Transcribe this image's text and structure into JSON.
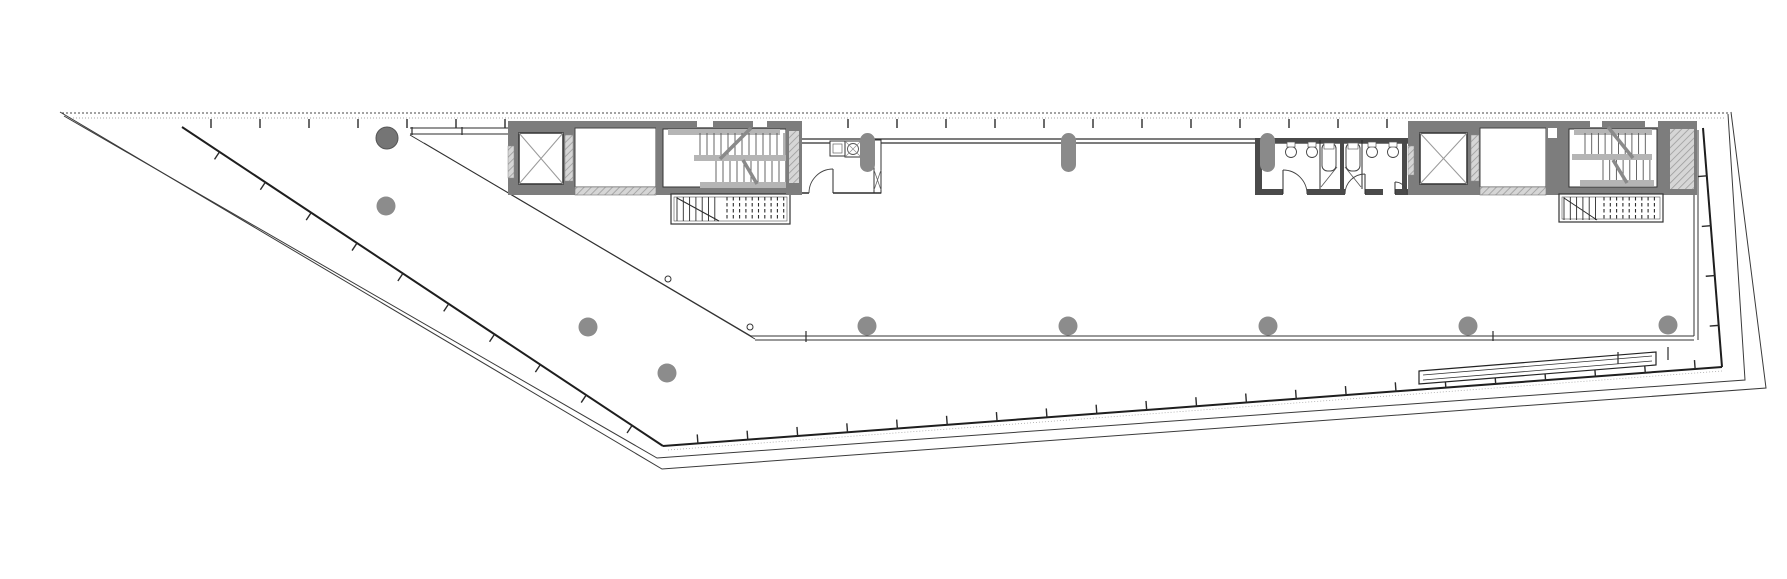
{
  "document": {
    "type": "architectural-floor-plan",
    "description": "Wedge-shaped office floor plate with two cores, drawn as black line work on white"
  },
  "canvas": {
    "width": 1787,
    "height": 579,
    "background": "#ffffff"
  },
  "colors": {
    "ink": "#2b2b2b",
    "thin": "#3a3a3a",
    "wall_gray": "#7d7d7d",
    "dark_wall": "#4a4a4a",
    "hatch_gray": "#c9c9c9",
    "landing_gray": "#b5b5b5",
    "tread": "#555555",
    "light_gray": "#9a9a9a",
    "column_gray": "#8c8c8c",
    "column_dark": "#757575",
    "dotted_gray": "#aaaaaa"
  },
  "top_edge": {
    "dashed_lines": [
      {
        "x1": 62,
        "y1": 113,
        "x2": 1729,
        "y2": 113,
        "color": "#444444",
        "dash": "2 2",
        "w": 1
      },
      {
        "x1": 70,
        "y1": 118,
        "x2": 1725,
        "y2": 118,
        "color": "#aaaaaa",
        "dash": "1 2",
        "w": 1
      }
    ],
    "ticks": {
      "y1": 119,
      "y2": 128,
      "x_start": 211,
      "x_end": 1690,
      "step": 49,
      "skip": [
        [
          506,
          800
        ],
        [
          1408,
          1700
        ]
      ]
    }
  },
  "outer_outline": {
    "a": [
      [
        64,
        116
      ],
      [
        657,
        458
      ],
      [
        1745,
        380
      ],
      [
        1728,
        114
      ]
    ],
    "b": [
      [
        60,
        112
      ],
      [
        662,
        469
      ],
      [
        1766,
        388
      ],
      [
        1731,
        112
      ]
    ]
  },
  "glass_perimeter": {
    "tick_len": 9,
    "segments": [
      {
        "x1": 182,
        "y1": 127,
        "x2": 663,
        "y2": 446,
        "nx": -0.553,
        "ny": 0.833,
        "step": 55,
        "start": 45
      },
      {
        "x1": 663,
        "y1": 446,
        "x2": 1722,
        "y2": 367,
        "nx": -0.074,
        "ny": -0.997,
        "step": 50,
        "start": 35
      },
      {
        "x1": 1703,
        "y1": 128,
        "x2": 1722,
        "y2": 367,
        "nx": -0.997,
        "ny": 0.079,
        "step": 50,
        "start": 48
      }
    ],
    "companion_dotted": {
      "x1": 668,
      "y1": 450,
      "x2": 1722,
      "y2": 371
    }
  },
  "atrium_boundary": {
    "diag1": [
      410,
      135,
      751,
      336
    ],
    "diag2": [
      424,
      143,
      755,
      339
    ],
    "horiz1": [
      751,
      336,
      1694,
      336
    ],
    "horiz2": [
      755,
      340,
      1694,
      340
    ],
    "vert1": [
      1694,
      130,
      1694,
      336
    ],
    "vert2": [
      1698,
      130,
      1698,
      340
    ],
    "ticks": [
      [
        806,
        331,
        806,
        342
      ],
      [
        1493,
        331,
        1493,
        341
      ]
    ],
    "small_circles": [
      [
        668,
        279
      ],
      [
        750,
        327
      ]
    ]
  },
  "band": {
    "left_stub_lines": [
      [
        410,
        128,
        508,
        128
      ],
      [
        410,
        134,
        508,
        134
      ]
    ],
    "left_stub_ticks": [
      [
        412,
        127,
        412,
        135
      ],
      [
        462,
        127,
        462,
        135
      ]
    ],
    "wall_lines": [
      [
        802,
        139,
        1412,
        139
      ],
      [
        802,
        143,
        1412,
        143
      ]
    ]
  },
  "left_core": {
    "elevator": {
      "wall": [
        508,
        121,
        67,
        74
      ],
      "cab": [
        519,
        133,
        44,
        51
      ],
      "doors": [
        [
          508,
          146,
          6,
          32
        ],
        [
          565,
          135,
          8,
          46
        ]
      ]
    },
    "lobby": {
      "room": [
        575,
        128,
        81,
        59
      ],
      "top_wall": [
        575,
        121,
        81,
        7
      ],
      "bottom_wall": [
        575,
        187,
        81,
        8
      ]
    },
    "stair": {
      "wall": [
        656,
        121,
        137,
        74
      ],
      "interior": [
        663,
        129,
        123,
        58
      ],
      "landings": [
        [
          668,
          129,
          112,
          6
        ],
        [
          694,
          155,
          92,
          6
        ],
        [
          700,
          182,
          86,
          6
        ]
      ],
      "flights": [
        {
          "x1": 700,
          "x2": 784,
          "y1": 133,
          "y2": 155,
          "step": 7
        },
        {
          "x1": 716,
          "x2": 784,
          "y1": 161,
          "y2": 182,
          "step": 7
        }
      ],
      "diagonals": [
        [
          751,
          128,
          720,
          159
        ],
        [
          743,
          160,
          757,
          184
        ]
      ]
    },
    "vents": [
      [
        697,
        121,
        16,
        6
      ],
      [
        753,
        121,
        14,
        6
      ]
    ],
    "ext_stair": {
      "outer": [
        671,
        194,
        119,
        30
      ],
      "inner": [
        674,
        197,
        113,
        24
      ],
      "solid": {
        "x1": 677,
        "x2": 721,
        "y1": 197,
        "y2": 221,
        "step": 6.3
      },
      "dashed": {
        "x1": 727,
        "x2": 786,
        "y1": 197,
        "y2": 221,
        "step": 6.3
      },
      "diag": [
        677,
        198,
        719,
        221
      ]
    },
    "right_wall": [
      786,
      121,
      16,
      74
    ],
    "right_wall_hatch": [
      789,
      131,
      10,
      52
    ]
  },
  "kitchenette": {
    "room_right_wall": [
      874,
      140,
      7,
      53
    ],
    "brace": [
      874,
      170,
      7,
      20
    ],
    "counter": [
      830,
      141,
      15,
      15
    ],
    "counter_inner": [
      833,
      144,
      9,
      9
    ],
    "sink": [
      845,
      141,
      16,
      16
    ],
    "sink_circle": [
      853,
      149,
      5.5
    ],
    "capsule_local": [
      860,
      133,
      15,
      39
    ],
    "bottom_wall": [
      [
        802,
        193,
        809,
        193
      ],
      [
        833,
        193,
        881,
        193
      ]
    ],
    "door": [
      833,
      193,
      24,
      -1
    ]
  },
  "restrooms": {
    "top_wall": [
      1255,
      138,
      153,
      5
    ],
    "left_wall": [
      1255,
      141,
      7,
      50
    ],
    "mid_wall": [
      1340,
      141,
      4,
      48
    ],
    "right_wall": [
      1402,
      141,
      5,
      48
    ],
    "bottom_segments": [
      [
        1255,
        189,
        28,
        6
      ],
      [
        1307,
        189,
        38,
        6
      ],
      [
        1365,
        189,
        18,
        6
      ],
      [
        1395,
        189,
        13,
        6
      ]
    ],
    "stall_lines": [
      [
        1320,
        140,
        1320,
        189
      ],
      [
        1362,
        140,
        1362,
        189
      ]
    ],
    "stall_diags": [
      [
        1321,
        187,
        1337,
        167
      ],
      [
        1361,
        187,
        1345,
        167
      ]
    ],
    "toilets": [
      [
        1322,
        143
      ],
      [
        1346,
        143
      ]
    ],
    "basins": [
      [
        1291,
        152
      ],
      [
        1312,
        152
      ],
      [
        1372,
        152
      ],
      [
        1393,
        152
      ]
    ],
    "doors": [
      [
        1283,
        194,
        24,
        1
      ],
      [
        1365,
        194,
        20,
        -1
      ],
      [
        1395,
        194,
        12,
        1
      ]
    ]
  },
  "right_core": {
    "elevator": {
      "wall": [
        1408,
        121,
        72,
        74
      ],
      "cab": [
        1420,
        133,
        47,
        51
      ],
      "doors": [
        [
          1408,
          146,
          6,
          29
        ],
        [
          1471,
          135,
          8,
          46
        ]
      ]
    },
    "lobby": {
      "room": [
        1480,
        128,
        66,
        59
      ],
      "top_wall": [
        1480,
        121,
        66,
        7
      ],
      "bottom_wall": [
        1480,
        187,
        66,
        8
      ]
    },
    "mid_wall": [
      1546,
      121,
      16,
      74
    ],
    "mid_wall_gap": [
      1548,
      128,
      9,
      10
    ],
    "stair": {
      "wall": [
        1562,
        121,
        102,
        74
      ],
      "interior": [
        1569,
        129,
        88,
        58
      ],
      "landings": [
        [
          1574,
          129,
          78,
          6
        ],
        [
          1572,
          154,
          80,
          6
        ],
        [
          1580,
          180,
          74,
          6
        ]
      ],
      "flights": [
        {
          "x1": 1585,
          "x2": 1652,
          "y1": 133,
          "y2": 154,
          "step": 6.7
        },
        {
          "x1": 1603,
          "x2": 1652,
          "y1": 160,
          "y2": 180,
          "step": 6.7
        }
      ],
      "diagonals": [
        [
          1608,
          127,
          1633,
          158
        ],
        [
          1613,
          160,
          1627,
          183
        ]
      ]
    },
    "right_wall": [
      1664,
      121,
      33,
      74
    ],
    "right_wall_hatch": [
      1670,
      129,
      24,
      60
    ],
    "vents": [
      [
        1590,
        121,
        12,
        6
      ],
      [
        1645,
        121,
        13,
        6
      ]
    ],
    "ext_stair": {
      "outer": [
        1559,
        194,
        104,
        28
      ],
      "inner": [
        1562,
        197,
        98,
        22
      ],
      "solid": {
        "x1": 1564,
        "x2": 1599,
        "y1": 197,
        "y2": 220,
        "step": 6.3
      },
      "dashed": {
        "x1": 1604,
        "x2": 1659,
        "y1": 197,
        "y2": 220,
        "step": 6.3
      },
      "diag": [
        1564,
        198,
        1597,
        220
      ]
    }
  },
  "columns": [
    {
      "x": 387,
      "y": 138,
      "r": 11,
      "shade": "dark"
    },
    {
      "x": 386,
      "y": 206,
      "r": 9.5,
      "shade": "normal"
    },
    {
      "x": 588,
      "y": 327,
      "r": 9.5,
      "shade": "normal"
    },
    {
      "x": 667,
      "y": 373,
      "r": 9.5,
      "shade": "normal"
    },
    {
      "x": 867,
      "y": 326,
      "r": 9.5,
      "shade": "normal"
    },
    {
      "x": 1068,
      "y": 326,
      "r": 9.5,
      "shade": "normal"
    },
    {
      "x": 1268,
      "y": 326,
      "r": 9.5,
      "shade": "normal"
    },
    {
      "x": 1468,
      "y": 326,
      "r": 9.5,
      "shade": "normal"
    },
    {
      "x": 1668,
      "y": 325,
      "r": 9.5,
      "shade": "normal"
    }
  ],
  "capsule_columns": [
    [
      860,
      133,
      15,
      39
    ],
    [
      1061,
      133,
      15,
      39
    ],
    [
      1260,
      133,
      15,
      39
    ]
  ],
  "roof_strip": {
    "outer": [
      [
        1419,
        371
      ],
      [
        1656,
        352
      ],
      [
        1656,
        365
      ],
      [
        1419,
        384
      ]
    ],
    "inner_lines": [
      [
        1423,
        375,
        1652,
        356
      ],
      [
        1423,
        380,
        1652,
        361
      ]
    ],
    "ticks": [
      [
        1618,
        352,
        1618,
        364
      ],
      [
        1668,
        347,
        1668,
        360
      ]
    ]
  }
}
